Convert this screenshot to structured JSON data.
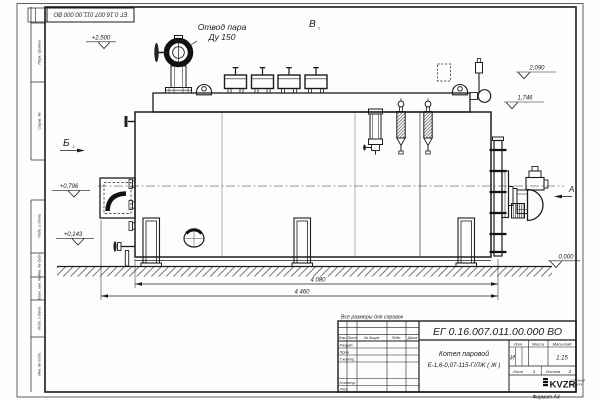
{
  "doc_number": "ЕГ 0.16.007.011.00.000  ВО",
  "frame": {
    "margin_labels": [
      "Перв. примен.",
      "Справ. №",
      "Подп. и дата",
      "Инв. № дубл.",
      "Взам. инв. №",
      "Подп. и дата",
      "Инв. № подл."
    ],
    "format_note": "Формат А3"
  },
  "drawing": {
    "callout": {
      "line1": "Отвод пара",
      "line2": "Ду 150"
    },
    "views": {
      "b": "Б",
      "v": "В",
      "a": "А",
      "sheet_ref": "2"
    },
    "elevations": [
      "+2,500",
      "2,090",
      "1,746",
      "+0,796",
      "+0,143",
      "0,000"
    ],
    "dimensions": [
      "4 080",
      "4 460"
    ],
    "reference_note": "Все размеры для справок"
  },
  "title_block": {
    "product_name_line1": "Котел паровой",
    "product_name_line2": "Е-1,6-0,07-115-Г/ЛЖ ( Ж )",
    "columns": [
      "Изм.",
      "Лист",
      "№ докум.",
      "Подп.",
      "Дата"
    ],
    "rows": [
      "Разраб.",
      "Пров.",
      "Т.контр.",
      "Н.контр.",
      "Утв."
    ],
    "litera_header": "Лит.",
    "mass_header": "Масса",
    "scale_header": "Масштаб",
    "litera": "И",
    "scale": "1:15",
    "sheet_label": "Лист",
    "sheet_number": "1",
    "sheets_label": "Листов",
    "sheets_total": "2",
    "company_logo": "KVZR",
    "company_line1": "КОТЕЛЬНЫЙ",
    "company_line2": "ЗАВОД РФ"
  }
}
